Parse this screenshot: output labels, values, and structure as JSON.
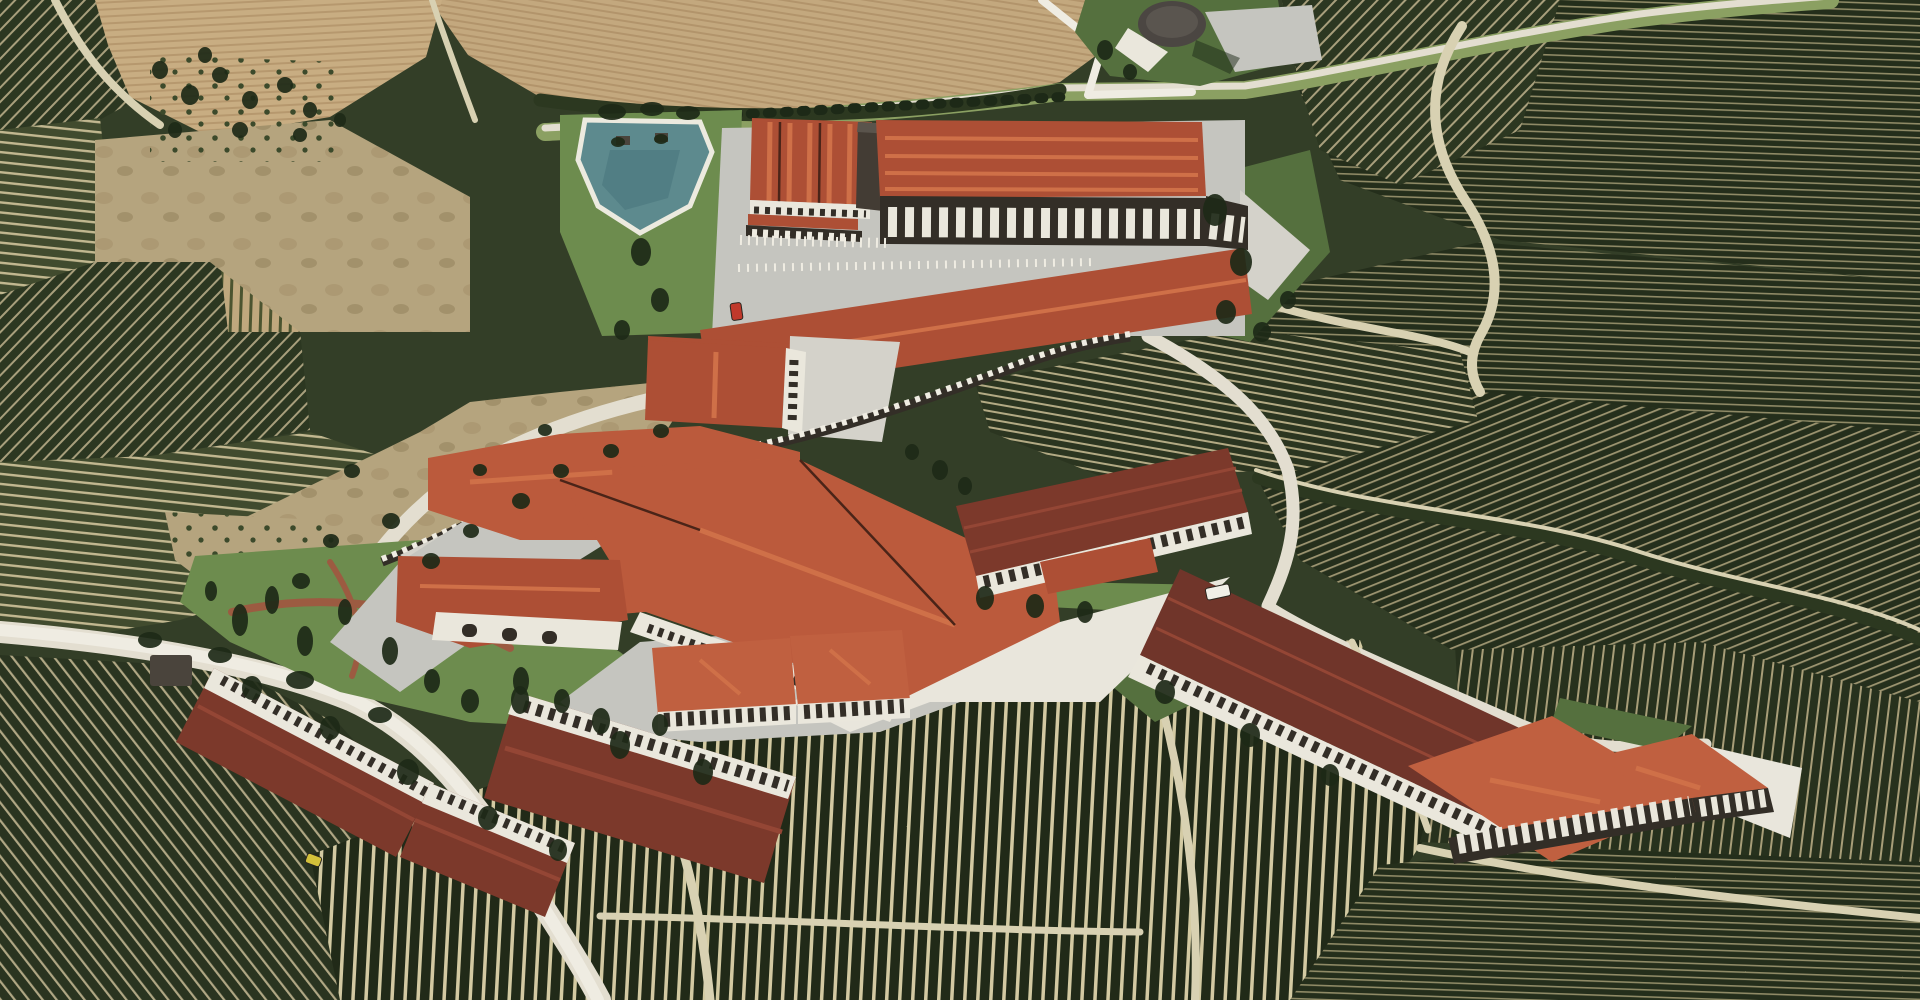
{
  "meta": {
    "kind": "aerial-photograph",
    "subject": "winery-estate-with-vineyards",
    "view": "oblique-aerial"
  },
  "palette": {
    "base_green": "#333e27",
    "road_light": "#e3ded0",
    "road_white": "#efece2",
    "road_grass": "#8ba062",
    "path_light": "#d8d1b2",
    "asphalt": "#c5c5bf",
    "asphalt_light": "#d4d2ca",
    "concrete_white": "#e9e6dc",
    "lawn": "#6d8c4e",
    "lawn_dark": "#55703e",
    "hedge_dark": "#2c3820",
    "field_tan": "#b5a47e",
    "pond_teal": "#5d8a8e",
    "pond_deep": "#49767d",
    "pond_rim": "#eceadf",
    "roof_red": "#ad4f35",
    "roof_orange": "#bb5a3c",
    "roof_bright": "#c06040",
    "roof_maroon": "#7c392b",
    "roof_dark_maroon": "#70352a",
    "ridge_light": "#cf7048",
    "ridge_maroon": "#944635",
    "eave_dark": "#4a2418",
    "facade_white": "#eae7dc",
    "window_dark": "#332e27",
    "tower_gray": "#433c34",
    "circle_roof": "#4b4642",
    "tree_dark": "#1d2917",
    "bush_green": "#3f4d2c",
    "gravel_red": "#9c5b41",
    "shed_dark": "#4a443c",
    "car_red": "#c0392b",
    "car_yellow": "#d4c13a",
    "truck_white": "#f1efe7"
  },
  "patterns": {
    "vine_d1": {
      "bg": "#2c3721",
      "stripe": "#a89f7c"
    },
    "vine_d2": {
      "bg": "#2a3420",
      "stripe": "#b0a784"
    },
    "vine_h": {
      "bg": "#414b2e",
      "stripe": "#c2b890"
    },
    "vine_hf": {
      "bg": "#242e1b",
      "stripe": "#8f8a66"
    },
    "vine_h3": {
      "bg": "#2b3520",
      "stripe": "#b3aa84"
    },
    "vine_v2": {
      "bg": "#212a18",
      "stripe": "#d3caa2"
    },
    "vine_v": {
      "bg": "#27311d",
      "stripe": "#a79d78"
    },
    "vine_d3": {
      "bg": "#252f1c",
      "stripe": "#9c9470"
    },
    "vine_sparse": {
      "bg": "#bfa87e",
      "stripe": "#4b5430"
    },
    "furrow_1": {
      "bg": "#c3a87e",
      "stripe": "#b2946b"
    },
    "furrow_2": {
      "bg": "#c8ad82",
      "stripe": "#b6986e"
    },
    "olive_dot": {
      "dot": "#3c4a2b"
    },
    "scrub_a": {
      "blob1": "#a3906a",
      "blob2": "#8d7a55"
    }
  },
  "scene": {
    "landmarks": [
      "triangular-irrigation-pond",
      "circular-pavilion-building",
      "upper-winery-warehouses",
      "main-winery-building",
      "colonnade-retaining-wall",
      "bottled-cellar-long-warehouse",
      "southeast-colonnade-warehouse",
      "guest-l-shaped-buildings",
      "plowed-fields",
      "vineyard-parcels",
      "olive-grove"
    ]
  },
  "trees": [
    [
      612,
      112,
      14,
      8
    ],
    [
      652,
      109,
      12,
      7
    ],
    [
      688,
      113,
      12,
      7
    ],
    [
      641,
      252,
      10,
      14
    ],
    [
      660,
      300,
      9,
      12
    ],
    [
      622,
      330,
      8,
      10
    ],
    [
      1215,
      210,
      12,
      16
    ],
    [
      1241,
      262,
      11,
      14
    ],
    [
      1226,
      312,
      10,
      12
    ],
    [
      1262,
      332,
      9,
      10
    ],
    [
      1288,
      300,
      8,
      9
    ],
    [
      240,
      620,
      8,
      16
    ],
    [
      272,
      600,
      7,
      14
    ],
    [
      305,
      641,
      8,
      15
    ],
    [
      345,
      612,
      7,
      13
    ],
    [
      390,
      651,
      8,
      14
    ],
    [
      432,
      681,
      8,
      12
    ],
    [
      470,
      701,
      9,
      12
    ],
    [
      521,
      681,
      8,
      14
    ],
    [
      562,
      701,
      8,
      12
    ],
    [
      601,
      721,
      9,
      13
    ],
    [
      211,
      591,
      6,
      10
    ],
    [
      352,
      471,
      8,
      7
    ],
    [
      391,
      521,
      9,
      8
    ],
    [
      331,
      541,
      8,
      7
    ],
    [
      301,
      581,
      9,
      8
    ],
    [
      431,
      561,
      9,
      8
    ],
    [
      471,
      531,
      8,
      7
    ],
    [
      521,
      501,
      9,
      8
    ],
    [
      561,
      471,
      8,
      7
    ],
    [
      611,
      451,
      8,
      7
    ],
    [
      661,
      431,
      8,
      7
    ],
    [
      545,
      430,
      7,
      6
    ],
    [
      480,
      470,
      7,
      6
    ],
    [
      252,
      688,
      10,
      12
    ],
    [
      330,
      728,
      10,
      12
    ],
    [
      408,
      772,
      11,
      13
    ],
    [
      488,
      818,
      10,
      12
    ],
    [
      558,
      850,
      9,
      11
    ],
    [
      520,
      700,
      9,
      14
    ],
    [
      620,
      745,
      10,
      14
    ],
    [
      703,
      772,
      10,
      13
    ],
    [
      660,
      725,
      8,
      11
    ],
    [
      985,
      598,
      9,
      12
    ],
    [
      1035,
      606,
      9,
      12
    ],
    [
      1085,
      612,
      8,
      11
    ],
    [
      1165,
      692,
      10,
      12
    ],
    [
      1250,
      735,
      10,
      12
    ],
    [
      1330,
      775,
      9,
      11
    ],
    [
      1105,
      50,
      8,
      10
    ],
    [
      1130,
      72,
      7,
      8
    ],
    [
      160,
      70,
      8,
      9
    ],
    [
      190,
      95,
      9,
      10
    ],
    [
      220,
      75,
      8,
      8
    ],
    [
      250,
      100,
      8,
      9
    ],
    [
      285,
      85,
      8,
      8
    ],
    [
      310,
      110,
      7,
      8
    ],
    [
      175,
      130,
      7,
      8
    ],
    [
      240,
      130,
      8,
      8
    ],
    [
      300,
      135,
      7,
      7
    ],
    [
      340,
      120,
      6,
      7
    ],
    [
      205,
      55,
      7,
      8
    ],
    [
      150,
      640,
      12,
      8
    ],
    [
      220,
      655,
      12,
      8
    ],
    [
      300,
      680,
      14,
      9
    ],
    [
      380,
      715,
      12,
      8
    ],
    [
      940,
      470,
      8,
      10
    ],
    [
      965,
      486,
      7,
      9
    ],
    [
      912,
      452,
      7,
      8
    ],
    [
      618,
      142,
      7,
      5
    ],
    [
      661,
      139,
      7,
      5
    ]
  ],
  "cars": [
    {
      "name": "red-car",
      "x": 731,
      "y": 303,
      "w": 11,
      "h": 17,
      "rot": -8,
      "color_key": "car_red"
    },
    {
      "name": "yellow-car",
      "x": 306,
      "y": 855,
      "w": 15,
      "h": 10,
      "rot": 20,
      "color_key": "car_yellow"
    },
    {
      "name": "white-truck",
      "x": 1206,
      "y": 586,
      "w": 24,
      "h": 12,
      "rot": -12,
      "color_key": "truck_white"
    }
  ]
}
